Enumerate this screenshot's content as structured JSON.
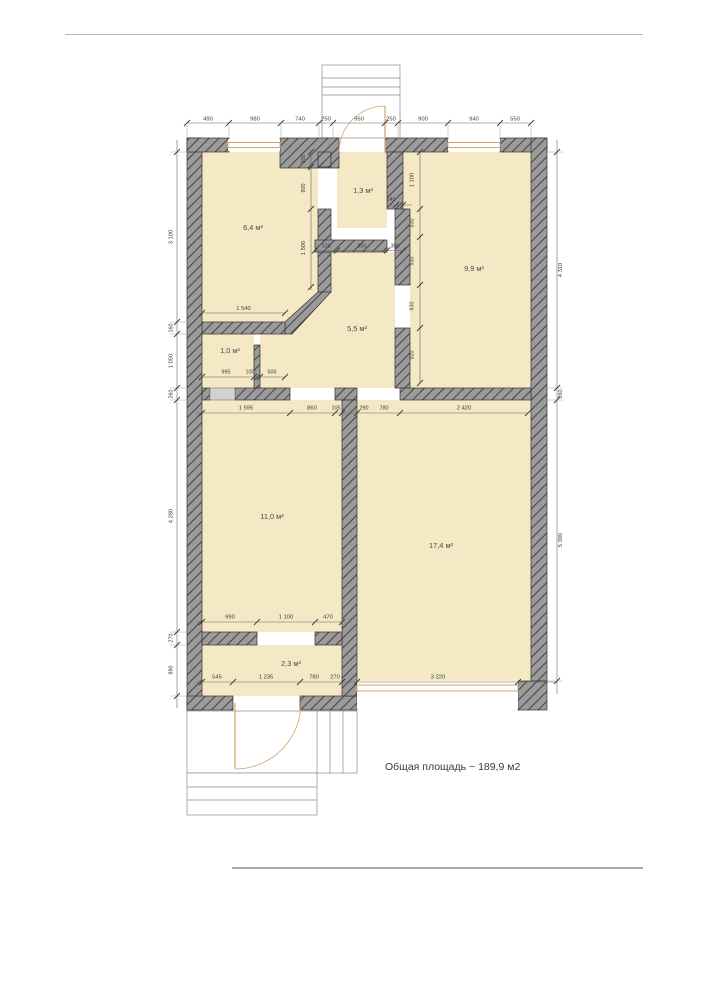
{
  "total_area_label": "Общая площадь ~ 189,9 м2",
  "rooms": [
    "6,4 м²",
    "1,3 м²",
    "9,9 м²",
    "5,5 м²",
    "1,0 м²",
    "11,0 м²",
    "17,4 м²",
    "2,3 м²"
  ],
  "dims": {
    "top": [
      "490",
      "980",
      "740",
      "250",
      "950",
      "250",
      "900",
      "940",
      "550"
    ],
    "left": [
      "3 100",
      "160",
      "1 050",
      "260",
      "4 280",
      "270",
      "890"
    ],
    "right": [
      "4 310",
      "260",
      "5 390"
    ],
    "partition": [
      "300",
      "800",
      "1 500"
    ],
    "wc_right": [
      "1 100",
      "140",
      "530",
      "930",
      "830",
      "920"
    ],
    "wc_bottom": [
      "325",
      "950",
      "300"
    ],
    "room64_bottom": [
      "1 540"
    ],
    "room10_bottom": [
      "995",
      "100",
      "500"
    ],
    "mid_section": [
      "1 595",
      "860",
      "105",
      "290",
      "780",
      "2 420"
    ],
    "room110_bottom": [
      "990",
      "1 100",
      "470"
    ],
    "room23_bottom": [
      "545",
      "1 235",
      "780",
      "270"
    ],
    "room174_bottom": [
      "3 220"
    ]
  },
  "colors": {
    "wall_base": "#9b9b9b",
    "wall_hatch": "#454545",
    "room_fill": "#f4e9c4",
    "frame_orange": "#d9a469",
    "dim_line": "#666666"
  }
}
